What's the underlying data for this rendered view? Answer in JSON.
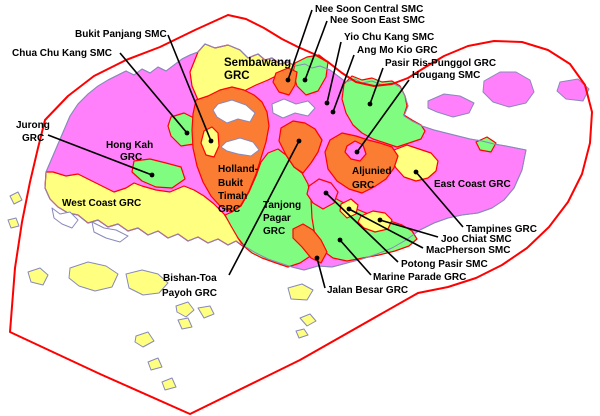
{
  "map_title": "Singapore electoral constituencies map",
  "colors": {
    "magenta": "#ff80fa",
    "yellow": "#ffff80",
    "green": "#80fc80",
    "orange": "#fb7c33",
    "boundary_red": "#ff0000",
    "coastline": "#8889bb",
    "background": "#ffffff",
    "label_text": "#000000"
  },
  "labels": [
    {
      "name": "Chua Chu Kang SMC",
      "lines": [
        "Chua Chu Kang SMC"
      ]
    },
    {
      "name": "Bukit Panjang SMC",
      "lines": [
        "Bukit Panjang SMC"
      ]
    },
    {
      "name": "Jurong GRC",
      "lines": [
        "Jurong",
        "GRC"
      ]
    },
    {
      "name": "Nee Soon Central SMC",
      "lines": [
        "Nee Soon Central SMC"
      ]
    },
    {
      "name": "Nee Soon East SMC",
      "lines": [
        "Nee Soon East SMC"
      ]
    },
    {
      "name": "Yio Chu Kang SMC",
      "lines": [
        "Yio Chu Kang SMC"
      ]
    },
    {
      "name": "Ang Mo Kio GRC",
      "lines": [
        "Ang Mo Kio GRC"
      ]
    },
    {
      "name": "Pasir Ris-Punggol GRC",
      "lines": [
        "Pasir Ris-Punggol GRC"
      ]
    },
    {
      "name": "Hougang SMC",
      "lines": [
        "Hougang SMC"
      ]
    },
    {
      "name": "Sembawang GRC",
      "lines": [
        "Sembawang",
        "GRC"
      ]
    },
    {
      "name": "Hong Kah GRC",
      "lines": [
        "Hong Kah",
        "GRC"
      ]
    },
    {
      "name": "Holland-Bukit Timah GRC",
      "lines": [
        "Holland-",
        "Bukit",
        "Timah",
        "GRC"
      ]
    },
    {
      "name": "West Coast GRC",
      "lines": [
        "West Coast GRC"
      ]
    },
    {
      "name": "Tanjong Pagar GRC",
      "lines": [
        "Tanjong",
        "Pagar",
        "GRC"
      ]
    },
    {
      "name": "Aljunied GRC",
      "lines": [
        "Aljunied",
        "GRC"
      ]
    },
    {
      "name": "East Coast GRC",
      "lines": [
        "East Coast GRC"
      ]
    },
    {
      "name": "Tampines GRC",
      "lines": [
        "Tampines GRC"
      ]
    },
    {
      "name": "Joo Chiat SMC",
      "lines": [
        "Joo Chiat SMC"
      ]
    },
    {
      "name": "MacPherson SMC",
      "lines": [
        "MacPherson SMC"
      ]
    },
    {
      "name": "Potong Pasir SMC",
      "lines": [
        "Potong Pasir SMC"
      ]
    },
    {
      "name": "Marine Parade GRC",
      "lines": [
        "Marine Parade GRC"
      ]
    },
    {
      "name": "Jalan Besar GRC",
      "lines": [
        "Jalan Besar GRC"
      ]
    },
    {
      "name": "Bishan-Toa Payoh GRC",
      "lines": [
        "Bishan-Toa",
        "Payoh GRC"
      ]
    }
  ],
  "regions": [
    {
      "name": "Chua Chu Kang SMC",
      "type": "SMC",
      "color": "green"
    },
    {
      "name": "Bukit Panjang SMC",
      "type": "SMC",
      "color": "yellow"
    },
    {
      "name": "Jurong GRC",
      "type": "GRC",
      "color": "green"
    },
    {
      "name": "Nee Soon Central SMC",
      "type": "SMC",
      "color": "orange"
    },
    {
      "name": "Nee Soon East SMC",
      "type": "SMC",
      "color": "green"
    },
    {
      "name": "Yio Chu Kang SMC",
      "type": "SMC",
      "color": "magenta"
    },
    {
      "name": "Ang Mo Kio GRC",
      "type": "GRC",
      "color": "magenta"
    },
    {
      "name": "Pasir Ris-Punggol GRC",
      "type": "GRC",
      "color": "green"
    },
    {
      "name": "Hougang SMC",
      "type": "SMC",
      "color": "magenta"
    },
    {
      "name": "Sembawang GRC",
      "type": "GRC",
      "color": "yellow"
    },
    {
      "name": "Hong Kah GRC",
      "type": "GRC",
      "color": "magenta"
    },
    {
      "name": "Holland-Bukit Timah GRC",
      "type": "GRC",
      "color": "orange"
    },
    {
      "name": "West Coast GRC",
      "type": "GRC",
      "color": "yellow"
    },
    {
      "name": "Tanjong Pagar GRC",
      "type": "GRC",
      "color": "green"
    },
    {
      "name": "Aljunied GRC",
      "type": "GRC",
      "color": "orange"
    },
    {
      "name": "East Coast GRC",
      "type": "GRC",
      "color": "magenta"
    },
    {
      "name": "Tampines GRC",
      "type": "GRC",
      "color": "yellow"
    },
    {
      "name": "Joo Chiat SMC",
      "type": "SMC",
      "color": "yellow"
    },
    {
      "name": "MacPherson SMC",
      "type": "SMC",
      "color": "yellow"
    },
    {
      "name": "Potong Pasir SMC",
      "type": "SMC",
      "color": "magenta"
    },
    {
      "name": "Marine Parade GRC",
      "type": "GRC",
      "color": "green"
    },
    {
      "name": "Jalan Besar GRC",
      "type": "GRC",
      "color": "orange"
    },
    {
      "name": "Bishan-Toa Payoh GRC",
      "type": "GRC",
      "color": "orange"
    }
  ]
}
